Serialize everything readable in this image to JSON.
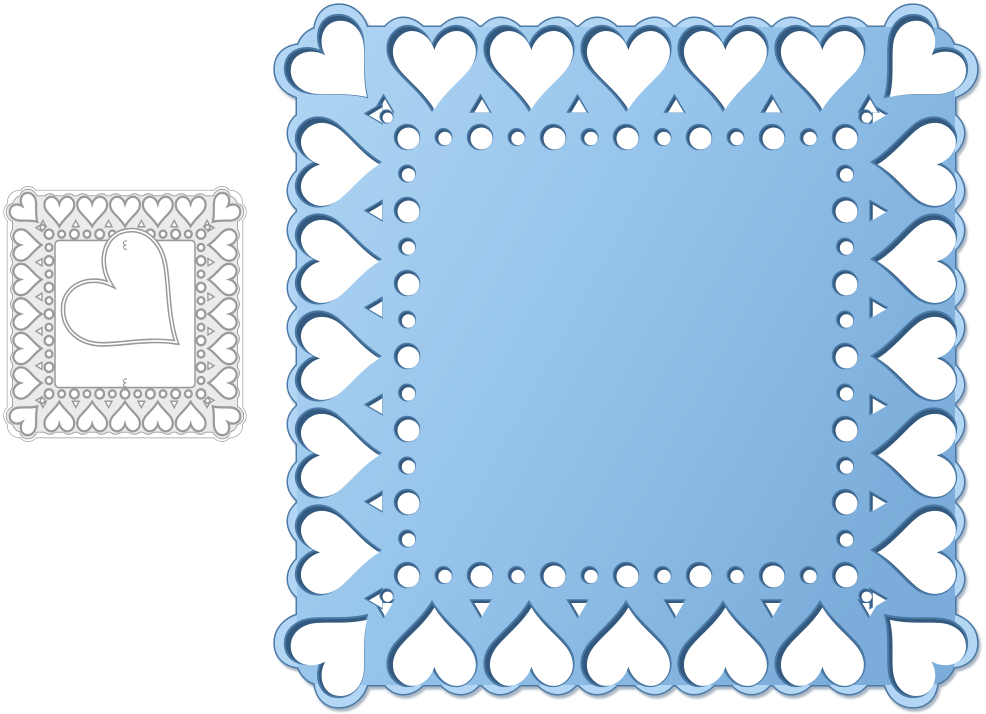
{
  "canvas": {
    "width": 986,
    "height": 714,
    "background": "#ffffff"
  },
  "scene": {
    "description": "Product photo of a heart lace square metal cutting die and its blue die-cut example",
    "items": [
      {
        "id": "metal-die",
        "label": "gray metal cutting die with heart border and center heart"
      },
      {
        "id": "blue-cutout",
        "label": "blue die-cut square doily with heart border"
      }
    ]
  },
  "die": {
    "x": 7,
    "y": 190,
    "size": 236,
    "y_scale": 1.051,
    "outer_inset": 0.5,
    "outer_radius": 12,
    "band_inset": 6,
    "corner_radius": 9,
    "band_fill": "#ebebeb",
    "stroke": "#9a9a9c",
    "hole_fill": "#ffffff",
    "outline_stroke_w": 1.3,
    "band_stroke_w": 1.7,
    "panel_inset": 48,
    "panel_radius": 4,
    "panel_stroke_w": 1.5,
    "hearts": {
      "per_side": 7,
      "inset": 19.5,
      "scale": 16.4,
      "blob_scale": 1.18,
      "outline_blob_scale": 1.34,
      "stroke_w": 2.2
    },
    "dots": {
      "per_side": 13,
      "inset": 42,
      "r_big": 4.4,
      "r_small": 3.4,
      "stroke_w": 2.2
    },
    "corner_dots": {
      "inset": 35.5,
      "r": 2.3,
      "stroke_w": 1.6
    },
    "notches": {
      "base_inset": 35,
      "height": 6,
      "half_width": 3.4,
      "stroke_w": 1.4
    },
    "center_heart": {
      "cx": 123,
      "cy": 106,
      "scale": 66,
      "rotate": -50,
      "stroke_w": 4.6,
      "inner_white_w": 1.6
    },
    "tabs": {
      "positions": [
        [
          118,
          52.5
        ],
        [
          118,
          183.5
        ]
      ],
      "stroke_w": 1.1
    }
  },
  "cutout": {
    "x": 280,
    "y": 10,
    "size": 692,
    "y_scale": 1.0,
    "band_inset": 17,
    "corner_radius": 26,
    "gradient": {
      "stops": [
        [
          0,
          "#b2d6f3"
        ],
        [
          0.5,
          "#96c4eb"
        ],
        [
          1,
          "#7cadda"
        ]
      ],
      "x2_factor": 1.0,
      "y2_factor": 0.55
    },
    "edge_color": "#4c79a5",
    "edge_width": 3,
    "rim_dark": "#33597f",
    "rim_mid": "#4a79a5",
    "hole_fill": "#ffffff",
    "hearts": {
      "per_side": 7,
      "inset": 55,
      "scale": 49,
      "blob_scale": 1.2,
      "white_scale": 0.93,
      "shift": 2.4
    },
    "dots": {
      "per_side": 13,
      "inset": 127,
      "r_big": 12.5,
      "r_small": 8.2,
      "rim": 1.5,
      "shift": 1.5
    },
    "corner_dots": {
      "inset": 106.5,
      "r": 6.5
    },
    "notches": {
      "base_inset": 102,
      "height": 17,
      "half_width": 10,
      "white_scale": 0.78,
      "shift_x": 1.5,
      "shift_y": 1.7
    }
  }
}
